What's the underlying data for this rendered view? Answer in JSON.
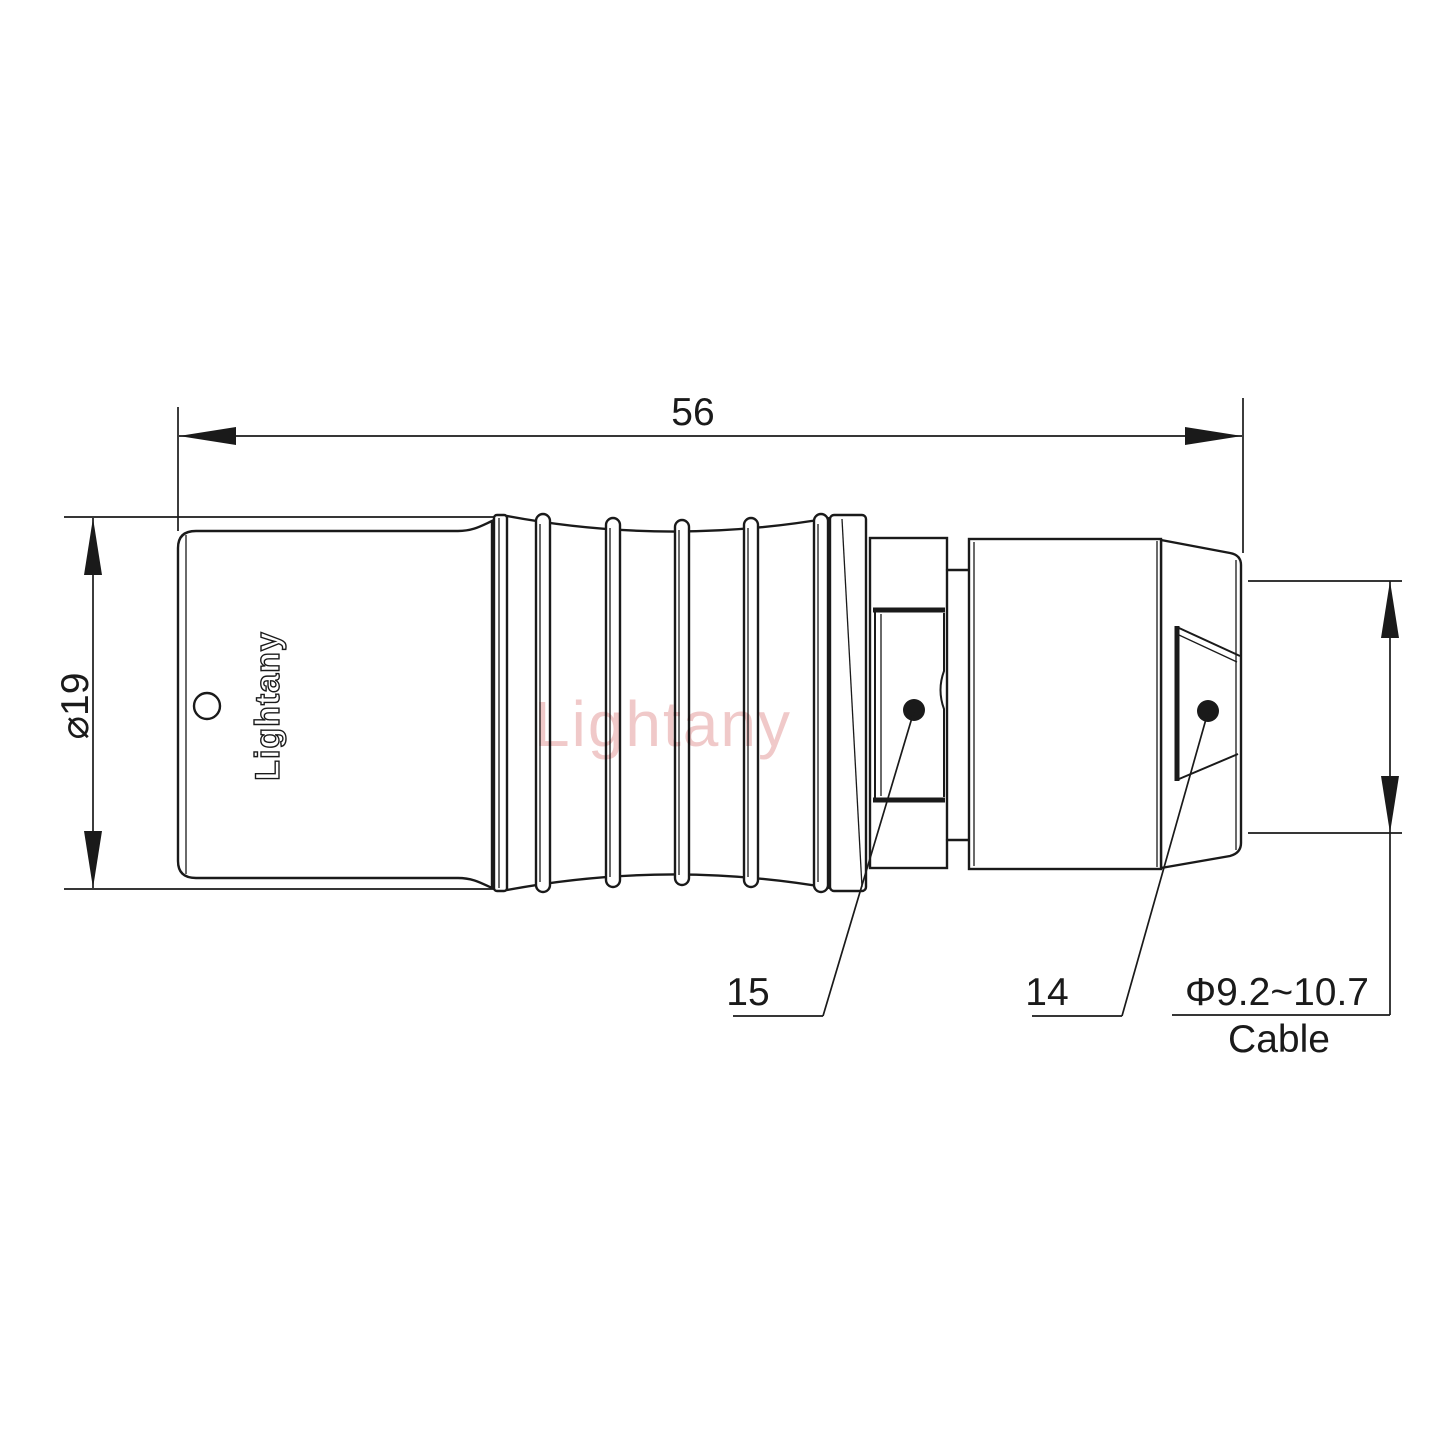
{
  "dimensions": {
    "overall_length": {
      "value": "56"
    },
    "diameter": {
      "value": "⌀19"
    },
    "cable": {
      "range": "Φ9.2~10.7",
      "label": "Cable"
    }
  },
  "part_labels": {
    "ferrule": "15",
    "nut": "14"
  },
  "branding": {
    "engraved": "Lightany",
    "watermark": "Lightany"
  },
  "colors": {
    "line": "#1a1a1a",
    "watermark": "#eec0c0",
    "background": "#ffffff"
  }
}
